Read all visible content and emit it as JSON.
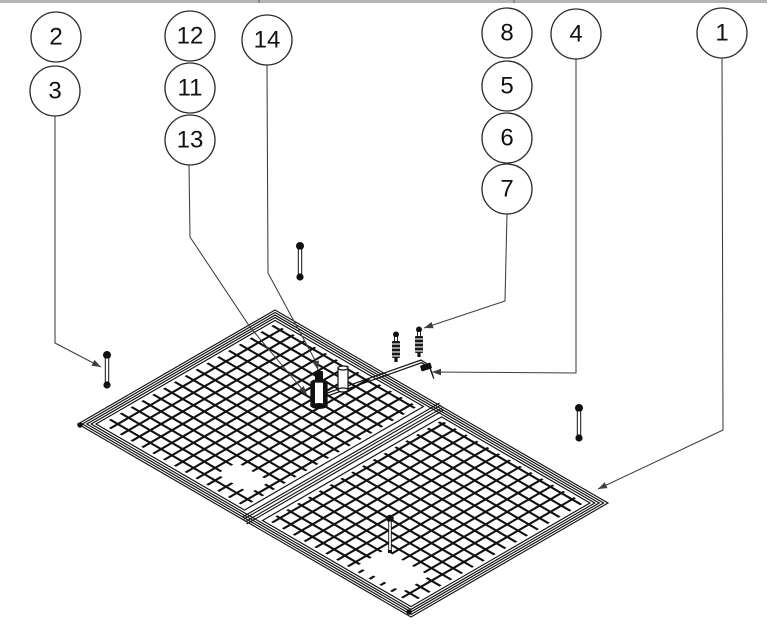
{
  "page": {
    "background": "#ffffff",
    "width": 771,
    "height": 637,
    "top_strip": {
      "color": "#b4b4b4",
      "tick_color": "#8a8a8a",
      "height_px": 3,
      "width_px": 767,
      "tick_positions_px": [
        258,
        513
      ]
    }
  },
  "diagram": {
    "type": "exploded-parts-diagram",
    "title": "Isometric line drawing of a two-section wire-mesh panel frame with numbered part callout balloons",
    "line_color": "#111111",
    "leader_color": "#3d3d3d",
    "balloon": {
      "radius": 25,
      "stroke": "#2e2e2e",
      "fill": "#ffffff",
      "text_color": "#111111",
      "font_size": 24
    },
    "balloons": [
      {
        "label": "2",
        "x": 56,
        "y": 37
      },
      {
        "label": "3",
        "x": 55,
        "y": 91
      },
      {
        "label": "12",
        "x": 190,
        "y": 36
      },
      {
        "label": "11",
        "x": 190,
        "y": 88
      },
      {
        "label": "13",
        "x": 190,
        "y": 140
      },
      {
        "label": "14",
        "x": 267,
        "y": 40
      },
      {
        "label": "8",
        "x": 507,
        "y": 33
      },
      {
        "label": "5",
        "x": 507,
        "y": 86
      },
      {
        "label": "6",
        "x": 507,
        "y": 138
      },
      {
        "label": "7",
        "x": 507,
        "y": 189
      },
      {
        "label": "4",
        "x": 576,
        "y": 34
      },
      {
        "label": "1",
        "x": 722,
        "y": 33
      }
    ],
    "leaders": [
      {
        "balloon": "3",
        "points": [
          [
            55,
            116
          ],
          [
            55,
            343
          ],
          [
            101,
            367
          ]
        ]
      },
      {
        "balloon": "13",
        "points": [
          [
            189,
            165
          ],
          [
            190,
            237
          ],
          [
            250,
            327
          ],
          [
            307,
            395
          ]
        ]
      },
      {
        "balloon": "14",
        "points": [
          [
            267,
            65
          ],
          [
            268,
            273
          ],
          [
            316,
            362
          ],
          [
            318,
            370
          ]
        ]
      },
      {
        "balloon": "7",
        "points": [
          [
            507,
            214
          ],
          [
            505,
            301
          ],
          [
            424,
            328
          ]
        ]
      },
      {
        "balloon": "4",
        "points": [
          [
            576,
            59
          ],
          [
            576,
            373
          ],
          [
            432,
            372
          ]
        ]
      },
      {
        "balloon": "1",
        "points": [
          [
            722,
            58
          ],
          [
            723,
            430
          ],
          [
            598,
            489
          ]
        ]
      }
    ],
    "frame": {
      "corners": {
        "left": [
          78,
          424
        ],
        "top": [
          275,
          310
        ],
        "right": [
          608,
          503
        ],
        "bottom": [
          411,
          617
        ]
      },
      "divider": {
        "from": [
          441.5,
          406.5
        ],
        "to": [
          244.5,
          520.5
        ],
        "offsets": [
          -4,
          -1.5,
          1.5,
          4
        ]
      },
      "tube_insets": [
        0,
        2.2,
        4.4,
        6.6
      ],
      "half_border_inset": 9,
      "mesh_inset": 12,
      "mesh_pitch": 12.5,
      "mesh_stroke_width": 2.1,
      "cutouts": [
        {
          "origin": [
            217,
            474
          ],
          "u_len": 38,
          "v_len": 23
        },
        {
          "origin": [
            357,
            566
          ],
          "u_len": 52,
          "v_len": 32
        }
      ],
      "corner_dots": [
        [
          80,
          425
        ],
        [
          409,
          612
        ]
      ]
    },
    "hardware": [
      {
        "type": "support-rod",
        "points": [
          [
            316,
            397
          ],
          [
            421,
            360
          ],
          [
            429,
            365
          ],
          [
            433,
            376
          ]
        ]
      },
      {
        "type": "rod-collar",
        "x": 426,
        "y": 367,
        "angle": -18
      },
      {
        "type": "leg-cylinder",
        "x": 319,
        "top": 371,
        "bottom": 408,
        "width": 16
      },
      {
        "type": "spacer-cylinder",
        "x": 343,
        "top": 366,
        "bottom": 392,
        "width": 10
      },
      {
        "type": "hex-bolt",
        "x": 107,
        "top": 351,
        "bottom": 389
      },
      {
        "type": "hex-bolt",
        "x": 300,
        "top": 242,
        "bottom": 281
      },
      {
        "type": "hex-bolt",
        "x": 579,
        "top": 404,
        "bottom": 442
      },
      {
        "type": "screw",
        "x": 396,
        "top": 332,
        "bottom": 362
      },
      {
        "type": "screw",
        "x": 419,
        "top": 327,
        "bottom": 357
      },
      {
        "type": "pin",
        "x": 390,
        "top": 515,
        "bottom": 553
      }
    ]
  }
}
